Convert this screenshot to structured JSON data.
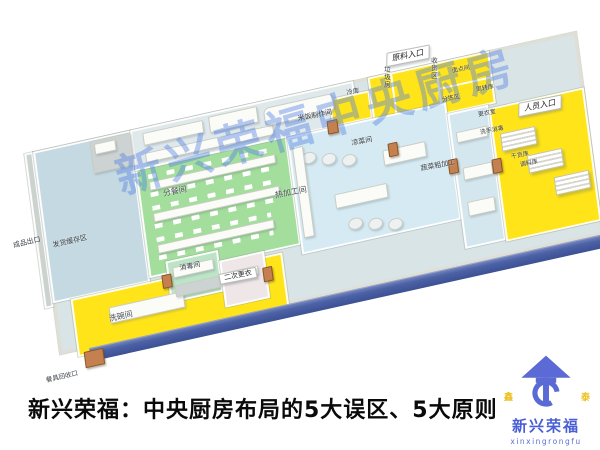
{
  "caption": {
    "text": "新兴荣福：中央厨房布局的5大误区、5大原则"
  },
  "watermark": {
    "text": "新兴荣福中央厨房"
  },
  "logo": {
    "name_cn": "新兴荣福",
    "name_en": "xinxingrongfu",
    "left_char": "鑫",
    "right_char": "泰",
    "brand_color": "#5b6ad4",
    "accent_yellow": "#edc11f"
  },
  "floorplan": {
    "entrance_flags": [
      {
        "text": "原料入口"
      },
      {
        "text": "人员入口"
      }
    ],
    "room_labels": [
      {
        "text": "成品出口"
      },
      {
        "text": "发货缓存区"
      },
      {
        "text": "分餐间"
      },
      {
        "text": "热加工间"
      },
      {
        "text": "米饭制作间"
      },
      {
        "text": "凉菜间"
      },
      {
        "text": "蔬菜粗加工"
      },
      {
        "text": "消毒间"
      },
      {
        "text": "二次更衣"
      },
      {
        "text": "洗碗间"
      },
      {
        "text": "餐具回收口"
      },
      {
        "text": "垃圾房"
      },
      {
        "text": "收货区"
      },
      {
        "text": "面点间"
      },
      {
        "text": "冷库"
      },
      {
        "text": "分拣区"
      },
      {
        "text": "周转库"
      },
      {
        "text": "更衣室"
      },
      {
        "text": "洗手消毒"
      },
      {
        "text": "干货库"
      },
      {
        "text": "调料库"
      }
    ],
    "colors": {
      "floor_base": "#d9e4e7",
      "left_area_blue": "#c5d9e2",
      "meal_room_green": "#a4de9d",
      "hot_room_blue": "#d5eaf2",
      "yellow_zone": "#ffe41a",
      "disinfect_green": "#bce4c6",
      "front_wall_band": "#43569b",
      "door_wood": "#c4814f"
    }
  }
}
